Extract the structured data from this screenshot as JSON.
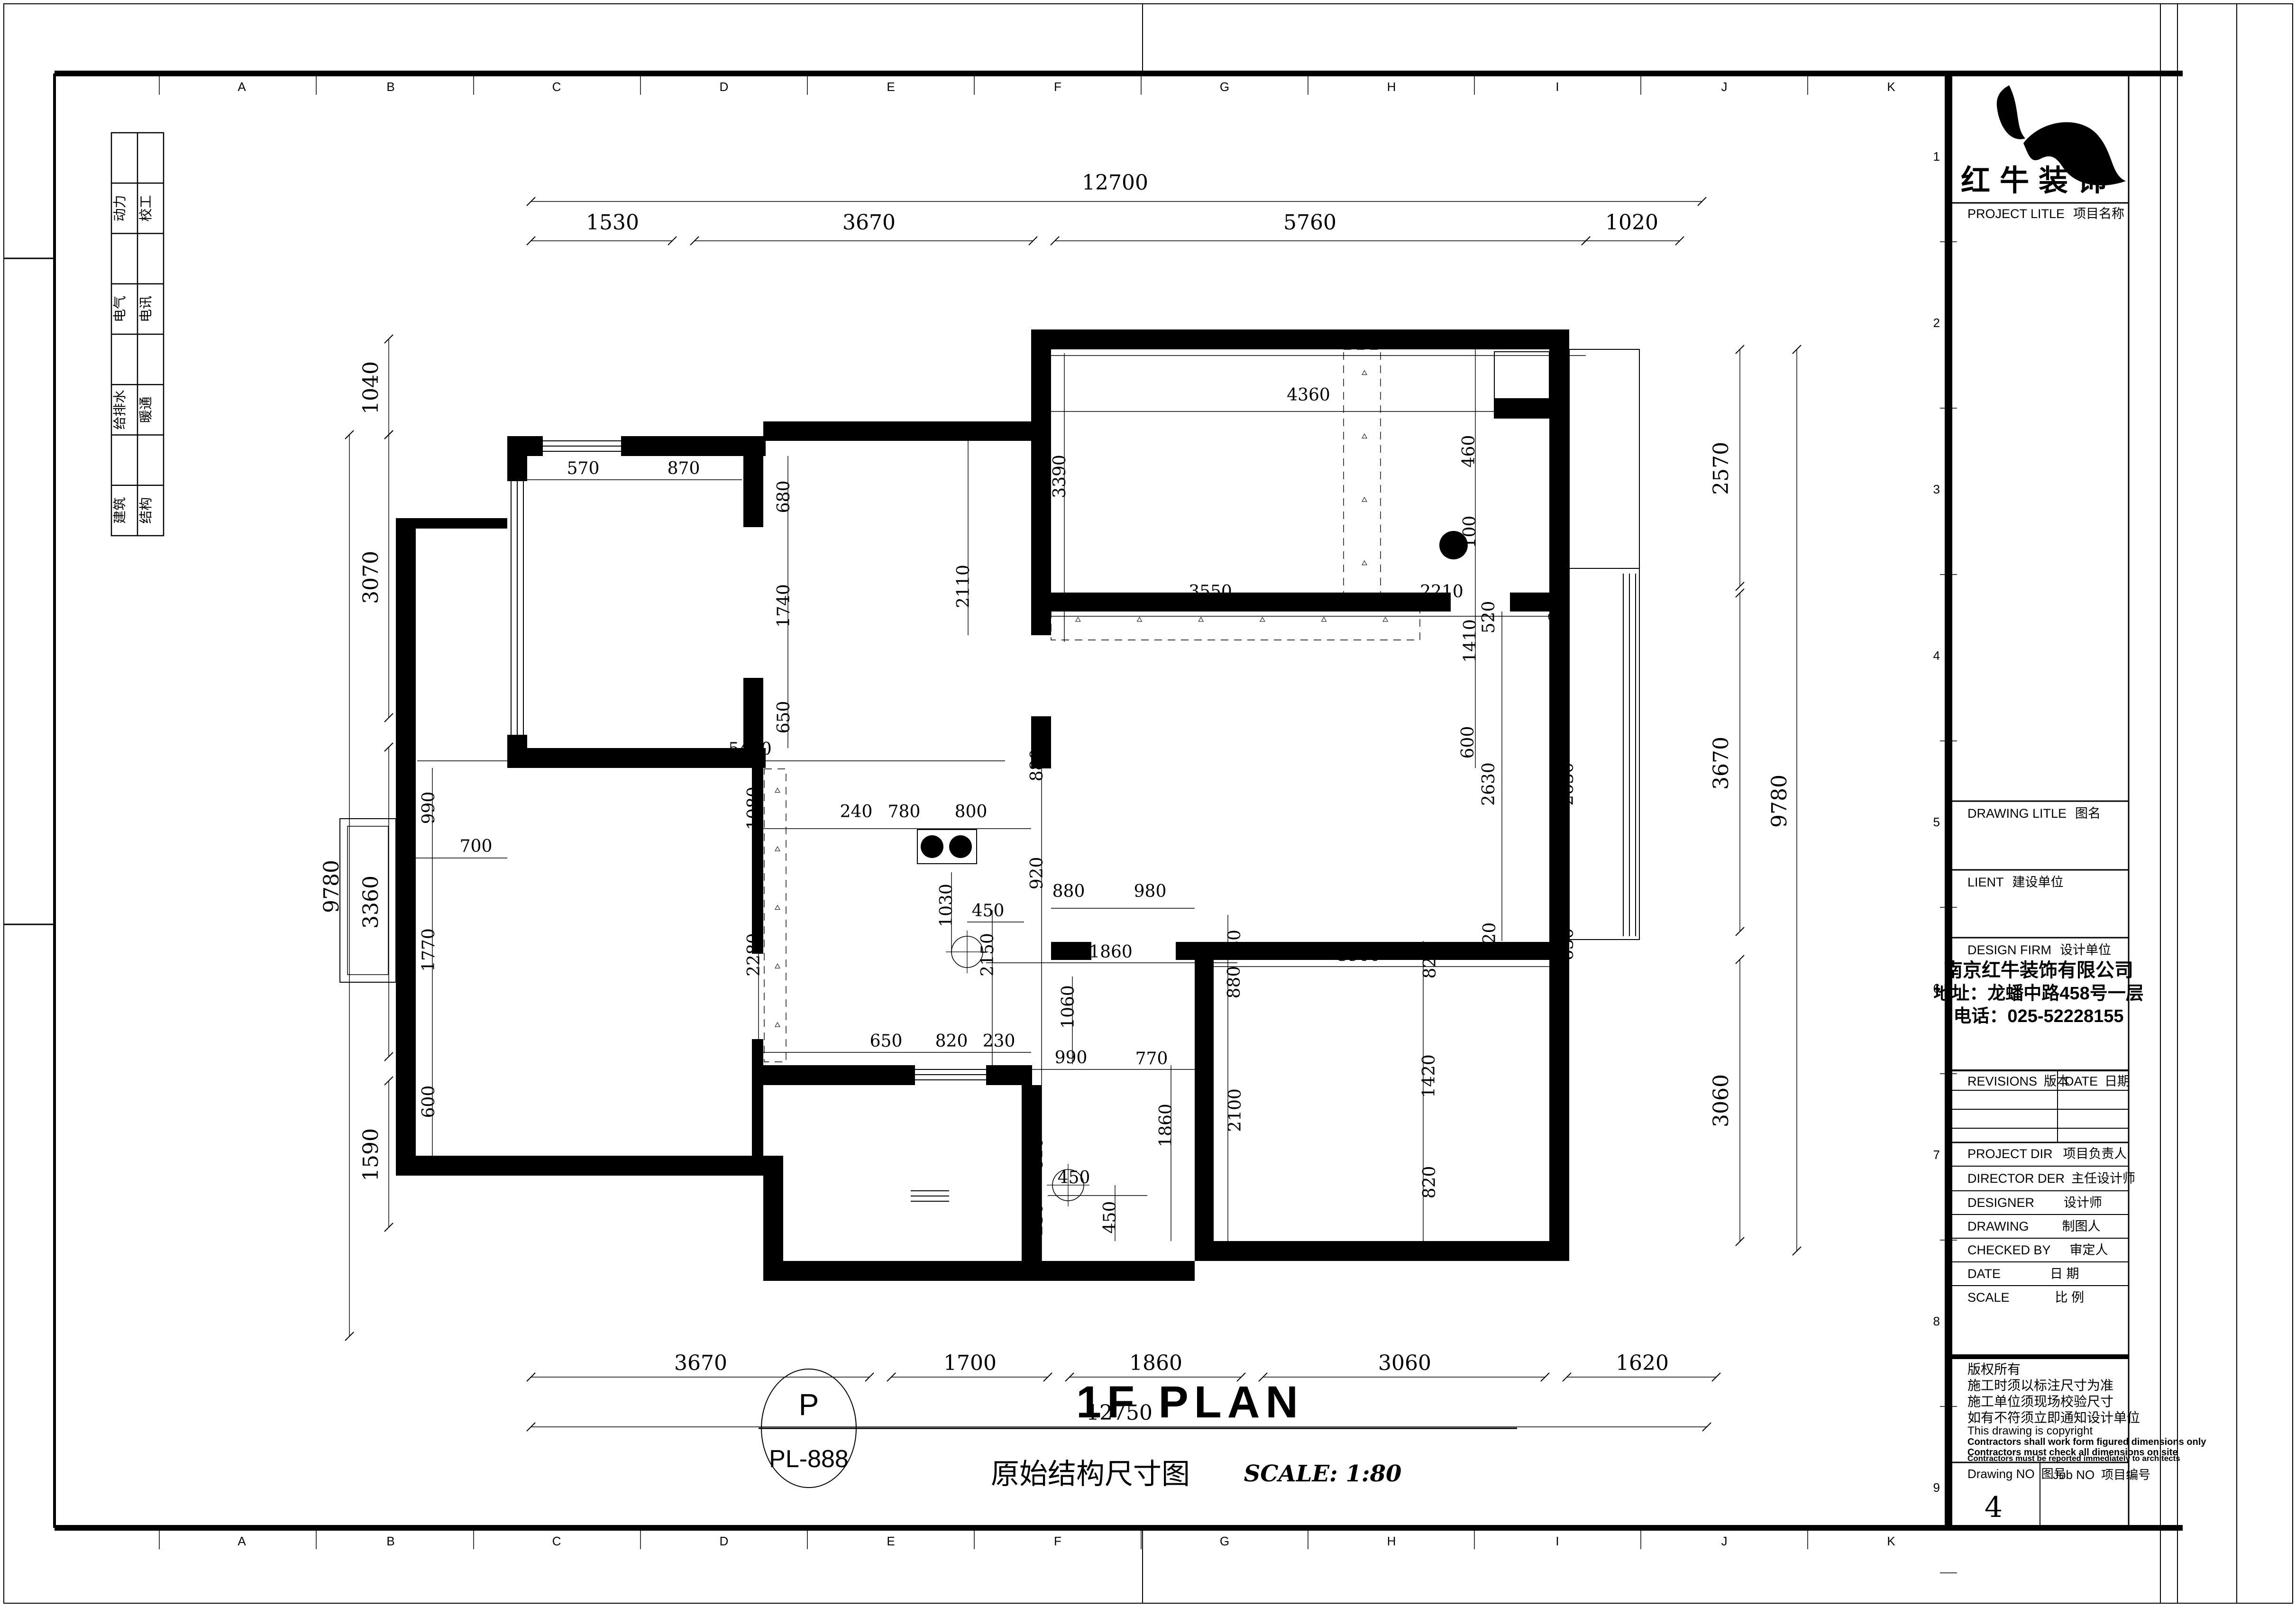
{
  "plan_title": {
    "bubble_top": "P",
    "bubble_bottom": "PL-888",
    "title_en": "1F PLAN",
    "title_cn": "原始结构尺寸图",
    "scale": "SCALE: 1:80"
  },
  "title_block": {
    "brand": "红牛装饰",
    "sections": {
      "project": "PROJECT LITLE",
      "project_cn": "项目名称",
      "drawing": "DRAWING LITLE",
      "drawing_cn": "图名",
      "client": "LIENT",
      "client_cn": "建设单位",
      "design_firm": "DESIGN FIRM",
      "design_firm_cn": "设计单位",
      "revisions": "REVISIONS",
      "revisions_cn": "版本",
      "date_col": "DATE",
      "date_col_cn": "日期",
      "project_dir": "PROJECT DIR",
      "project_dir_cn": "项目负责人",
      "director": "DIRECTOR DER",
      "director_cn": "主任设计师",
      "designer": "DESIGNER",
      "designer_cn": "设计师",
      "drawing_by": "DRAWING",
      "drawing_by_cn": "制图人",
      "checked": "CHECKED BY",
      "checked_cn": "审定人",
      "date": "DATE",
      "date_cn": "日  期",
      "scale": "SCALE",
      "scale_cn": "比  例"
    },
    "firm": {
      "name": "南京红牛装饰有限公司",
      "address": "地址：龙蟠中路458号一层",
      "phone": "电话：025-52228155"
    },
    "copyright": [
      "版权所有",
      "施工时须以标注尺寸为准",
      "施工单位须现场校验尺寸",
      "如有不符须立即通知设计单位",
      "This drawing is copyright",
      "Contractors shall work form figured dimensions only",
      "Contractors must check all dimensions on site",
      "Contractors must be reported immediately to architects"
    ],
    "drawing_no_label": "Drawing NO",
    "drawing_no_label_cn": "图号",
    "drawing_no": "4",
    "job_no_label": "Job NO",
    "job_no_label_cn": "项目编号"
  },
  "grid": {
    "letters": [
      "A",
      "B",
      "C",
      "D",
      "E",
      "F",
      "G",
      "H",
      "I",
      "J",
      "K"
    ],
    "letter_x": [
      510,
      824,
      1174,
      1527,
      1879,
      2231,
      2583,
      2935,
      3285,
      3637,
      3989
    ],
    "letter_ticks": [
      336,
      667,
      999,
      1351,
      1703,
      2055,
      2407,
      2759,
      3110,
      3461,
      3813
    ],
    "rows": [
      "1",
      "2",
      "3",
      "4",
      "5",
      "6",
      "7",
      "8",
      "9"
    ],
    "row_y": [
      330,
      681,
      1032,
      1383,
      1734,
      2085,
      2436,
      2787,
      3138
    ]
  },
  "discipline_table": {
    "rows": [
      {
        "c1": "动力",
        "c2": "校工"
      },
      {
        "c1": "电气",
        "c2": "电讯"
      },
      {
        "c1": "给排水",
        "c2": "暖通"
      },
      {
        "c1": "建筑",
        "c2": "结构"
      }
    ]
  },
  "plan": {
    "walls": [
      [
        1070,
        920,
        75,
        42
      ],
      [
        1310,
        920,
        305,
        42
      ],
      [
        1070,
        920,
        42,
        95
      ],
      [
        1070,
        1550,
        42,
        70
      ],
      [
        1070,
        1578,
        545,
        42
      ],
      [
        1568,
        962,
        42,
        150
      ],
      [
        1568,
        1430,
        42,
        148
      ],
      [
        835,
        1093,
        235,
        22
      ],
      [
        835,
        1093,
        42,
        1387
      ],
      [
        835,
        2438,
        775,
        42
      ],
      [
        1586,
        1620,
        24,
        392
      ],
      [
        1586,
        2192,
        24,
        246
      ],
      [
        1610,
        889,
        567,
        41
      ],
      [
        2175,
        695,
        42,
        235
      ],
      [
        2175,
        930,
        42,
        410
      ],
      [
        2175,
        1511,
        42,
        110
      ],
      [
        2175,
        695,
        1135,
        42
      ],
      [
        3268,
        737,
        42,
        1923
      ],
      [
        2217,
        1250,
        843,
        40
      ],
      [
        3185,
        1250,
        83,
        40
      ],
      [
        2217,
        1987,
        85,
        38
      ],
      [
        2480,
        1987,
        788,
        38
      ],
      [
        2520,
        2025,
        40,
        593
      ],
      [
        2520,
        2618,
        790,
        42
      ],
      [
        1610,
        2247,
        320,
        42
      ],
      [
        2080,
        2247,
        97,
        42
      ],
      [
        2155,
        2289,
        42,
        413
      ],
      [
        1610,
        2660,
        910,
        42
      ],
      [
        1610,
        2438,
        42,
        264
      ],
      [
        3152,
        840,
        158,
        42
      ]
    ],
    "outlines": [
      [
        717,
        1727,
        118,
        345,
        2
      ],
      [
        733,
        1743,
        86,
        313,
        1.5
      ],
      [
        3310,
        737,
        148,
        462,
        2
      ],
      [
        3310,
        1199,
        148,
        783,
        2
      ],
      [
        1935,
        1750,
        125,
        72,
        2
      ],
      [
        3152,
        742,
        116,
        140,
        2
      ]
    ],
    "hatches": [
      [
        2217,
        1272,
        778,
        78
      ],
      [
        2834,
        737,
        78,
        535
      ],
      [
        1612,
        1622,
        46,
        618
      ]
    ],
    "lines": [
      [
        1145,
        930,
        1310,
        930,
        2
      ],
      [
        1145,
        941,
        1310,
        941,
        2
      ],
      [
        1145,
        952,
        1310,
        952,
        2
      ],
      [
        1078,
        1015,
        1078,
        1550,
        2
      ],
      [
        1091,
        1015,
        1091,
        1550,
        2
      ],
      [
        1104,
        1015,
        1104,
        1550,
        2
      ],
      [
        845,
        1745,
        845,
        2068,
        2
      ],
      [
        856,
        1745,
        856,
        2068,
        2
      ],
      [
        867,
        1745,
        867,
        2068,
        2
      ],
      [
        3276,
        890,
        3276,
        1165,
        2
      ],
      [
        3289,
        890,
        3289,
        1165,
        2
      ],
      [
        3302,
        890,
        3302,
        1165,
        2
      ],
      [
        3276,
        2075,
        3276,
        2350,
        2
      ],
      [
        3289,
        2075,
        3289,
        2350,
        2
      ],
      [
        3302,
        2075,
        3302,
        2350,
        2
      ],
      [
        3424,
        1210,
        3424,
        1975,
        2
      ],
      [
        3437,
        1210,
        3437,
        1975,
        2
      ],
      [
        3450,
        1210,
        3450,
        1975,
        2
      ],
      [
        1930,
        2256,
        2080,
        2256,
        2
      ],
      [
        1930,
        2267,
        2080,
        2267,
        2
      ],
      [
        1930,
        2278,
        2080,
        2278,
        2
      ],
      [
        1921,
        2512,
        2002,
        2512,
        2
      ],
      [
        1921,
        2523,
        2002,
        2523,
        2
      ],
      [
        1921,
        2534,
        2002,
        2534,
        2
      ]
    ],
    "dimlines": [
      [
        1120,
        425,
        3590,
        425,
        1
      ],
      [
        1120,
        508,
        1418,
        508,
        1
      ],
      [
        1465,
        508,
        2179,
        508,
        1
      ],
      [
        2225,
        508,
        3345,
        508,
        1
      ],
      [
        3345,
        508,
        3543,
        508,
        1
      ],
      [
        737,
        917,
        737,
        2819,
        1
      ],
      [
        820,
        715,
        820,
        917,
        1
      ],
      [
        820,
        917,
        820,
        1514,
        1
      ],
      [
        820,
        1576,
        820,
        2229,
        1
      ],
      [
        820,
        2280,
        820,
        2589,
        1
      ],
      [
        3790,
        737,
        3790,
        2639,
        1
      ],
      [
        3670,
        737,
        3670,
        1237,
        1
      ],
      [
        3670,
        1251,
        3670,
        1965,
        1
      ],
      [
        3670,
        2024,
        3670,
        2619,
        1
      ],
      [
        1120,
        2905,
        1834,
        2905,
        1
      ],
      [
        1880,
        2905,
        2210,
        2905,
        1
      ],
      [
        2256,
        2905,
        2618,
        2905,
        1
      ],
      [
        2664,
        2905,
        3259,
        2905,
        1
      ],
      [
        3305,
        2905,
        3620,
        2905,
        1
      ],
      [
        1120,
        3010,
        3600,
        3010,
        1
      ],
      [
        1112,
        1012,
        1565,
        1012,
        0
      ],
      [
        1662,
        962,
        1662,
        1578,
        0
      ],
      [
        2217,
        750,
        3345,
        750,
        0
      ],
      [
        2217,
        868,
        3268,
        868,
        0
      ],
      [
        3112,
        737,
        3112,
        1620,
        0
      ],
      [
        2245,
        745,
        2245,
        1354,
        0
      ],
      [
        2042,
        930,
        2042,
        1340,
        0
      ],
      [
        2175,
        1300,
        3268,
        1300,
        0
      ],
      [
        3168,
        1290,
        3168,
        1985,
        0
      ],
      [
        3294,
        1250,
        3294,
        2020,
        0
      ],
      [
        880,
        1605,
        2120,
        1605,
        0
      ],
      [
        1610,
        1748,
        2175,
        1748,
        0
      ],
      [
        912,
        1620,
        912,
        2438,
        0
      ],
      [
        1600,
        1620,
        1600,
        2240,
        0
      ],
      [
        877,
        1810,
        1070,
        1810,
        0
      ],
      [
        2197,
        1550,
        2197,
        2700,
        0
      ],
      [
        2217,
        1916,
        2520,
        1916,
        0
      ],
      [
        2080,
        2031,
        2610,
        2031,
        0
      ],
      [
        2262,
        2060,
        2262,
        2245,
        0
      ],
      [
        1610,
        2220,
        2175,
        2220,
        0
      ],
      [
        2175,
        2256,
        2520,
        2256,
        0
      ],
      [
        2470,
        2247,
        2470,
        2618,
        0
      ],
      [
        2590,
        1930,
        2590,
        2618,
        0
      ],
      [
        2520,
        2039,
        3268,
        2039,
        0
      ],
      [
        3002,
        1985,
        3002,
        2618,
        0
      ],
      [
        2210,
        2522,
        2420,
        2522,
        0
      ],
      [
        2352,
        2500,
        2352,
        2618,
        0
      ],
      [
        2093,
        1920,
        2093,
        2247,
        0
      ],
      [
        2007,
        1840,
        2007,
        2010,
        0
      ],
      [
        2040,
        1945,
        2160,
        1945,
        0
      ]
    ],
    "dims": [
      [
        "12700",
        2352,
        400,
        0,
        44
      ],
      [
        "1530",
        1292,
        484,
        0,
        44
      ],
      [
        "3670",
        1833,
        484,
        0,
        44
      ],
      [
        "5760",
        2763,
        484,
        0,
        44
      ],
      [
        "1020",
        3442,
        484,
        0,
        44
      ],
      [
        "90",
        2261,
        733,
        0,
        36
      ],
      [
        "950",
        2338,
        733,
        0,
        36
      ],
      [
        "4360",
        2760,
        845,
        0,
        36
      ],
      [
        "360",
        3194,
        882,
        0,
        36
      ],
      [
        "460",
        3110,
        952,
        -90,
        36
      ],
      [
        "100",
        3112,
        1122,
        -90,
        36
      ],
      [
        "1410",
        3113,
        1352,
        -90,
        36
      ],
      [
        "600",
        3108,
        1566,
        -90,
        36
      ],
      [
        "3390",
        2247,
        1005,
        -90,
        36
      ],
      [
        "2110",
        2044,
        1237,
        -90,
        36
      ],
      [
        "570",
        1230,
        1000,
        0,
        36
      ],
      [
        "870",
        1442,
        1000,
        0,
        36
      ],
      [
        "680",
        1665,
        1048,
        -90,
        36
      ],
      [
        "1740",
        1665,
        1278,
        -90,
        36
      ],
      [
        "650",
        1665,
        1513,
        -90,
        36
      ],
      [
        "9780",
        714,
        1870,
        -90,
        44
      ],
      [
        "1040",
        797,
        818,
        -90,
        44
      ],
      [
        "3070",
        797,
        1218,
        -90,
        44
      ],
      [
        "3360",
        797,
        1903,
        -90,
        44
      ],
      [
        "1590",
        797,
        2436,
        -90,
        44
      ],
      [
        "700",
        1004,
        1797,
        0,
        36
      ],
      [
        "5490",
        1582,
        1592,
        0,
        36
      ],
      [
        "990",
        916,
        1704,
        -90,
        36
      ],
      [
        "1770",
        916,
        2004,
        -90,
        36
      ],
      [
        "600",
        916,
        2324,
        -90,
        36
      ],
      [
        "1080",
        1602,
        1705,
        -90,
        36
      ],
      [
        "2280",
        1602,
        2014,
        -90,
        36
      ],
      [
        "240",
        1806,
        1724,
        0,
        36
      ],
      [
        "780",
        1907,
        1724,
        0,
        36
      ],
      [
        "800",
        2048,
        1724,
        0,
        36
      ],
      [
        "880",
        2199,
        1614,
        -90,
        36
      ],
      [
        "920",
        2199,
        1842,
        -90,
        36
      ],
      [
        "1030",
        2008,
        1910,
        -90,
        36
      ],
      [
        "450",
        2084,
        1933,
        0,
        36
      ],
      [
        "2150",
        2095,
        2014,
        -90,
        36
      ],
      [
        "650",
        1869,
        2208,
        0,
        36
      ],
      [
        "820",
        2007,
        2208,
        0,
        36
      ],
      [
        "230",
        2107,
        2208,
        0,
        36
      ],
      [
        "3550",
        2553,
        1260,
        0,
        36
      ],
      [
        "2210",
        3041,
        1260,
        0,
        36
      ],
      [
        "520",
        3152,
        1302,
        -90,
        36
      ],
      [
        "660",
        3293,
        1280,
        -90,
        36
      ],
      [
        "2630",
        3152,
        1654,
        -90,
        36
      ],
      [
        "2630",
        3318,
        1654,
        -90,
        36
      ],
      [
        "520",
        3154,
        1980,
        -90,
        36
      ],
      [
        "630",
        3318,
        1992,
        -90,
        36
      ],
      [
        "880",
        2254,
        1892,
        0,
        36
      ],
      [
        "980",
        2426,
        1892,
        0,
        36
      ],
      [
        "1860",
        2343,
        2020,
        0,
        36
      ],
      [
        "1060",
        2265,
        2124,
        -90,
        36
      ],
      [
        "990",
        2259,
        2243,
        0,
        36
      ],
      [
        "770",
        2429,
        2245,
        0,
        36
      ],
      [
        "810",
        2199,
        2434,
        -90,
        36
      ],
      [
        "230",
        2199,
        2573,
        -90,
        36
      ],
      [
        "450",
        2265,
        2496,
        0,
        36
      ],
      [
        "450",
        2353,
        2568,
        -90,
        36
      ],
      [
        "1860",
        2471,
        2374,
        -90,
        36
      ],
      [
        "80",
        2616,
        1984,
        -90,
        36
      ],
      [
        "880",
        2615,
        2072,
        -90,
        36
      ],
      [
        "2100",
        2617,
        2342,
        -90,
        36
      ],
      [
        "3900",
        2866,
        2027,
        0,
        36
      ],
      [
        "820",
        3028,
        2030,
        -90,
        36
      ],
      [
        "1420",
        3026,
        2270,
        -90,
        36
      ],
      [
        "820",
        3027,
        2494,
        -90,
        36
      ],
      [
        "2570",
        3645,
        988,
        -90,
        44
      ],
      [
        "3670",
        3645,
        1610,
        -90,
        44
      ],
      [
        "3060",
        3645,
        2322,
        -90,
        44
      ],
      [
        "9780",
        3768,
        1690,
        -90,
        44
      ],
      [
        "3670",
        1478,
        2890,
        0,
        44
      ],
      [
        "1700",
        2046,
        2890,
        0,
        44
      ],
      [
        "1860",
        2438,
        2890,
        0,
        44
      ],
      [
        "3060",
        2963,
        2890,
        0,
        44
      ],
      [
        "1620",
        3464,
        2890,
        0,
        44
      ],
      [
        "12750",
        2361,
        2995,
        0,
        44
      ]
    ],
    "circles": [
      [
        1966,
        1786,
        24,
        "f"
      ],
      [
        2026,
        1786,
        24,
        "f"
      ],
      [
        3066,
        1150,
        30,
        "f"
      ],
      [
        2040,
        2008,
        33,
        "c"
      ],
      [
        2253,
        2500,
        33,
        "c"
      ]
    ]
  }
}
